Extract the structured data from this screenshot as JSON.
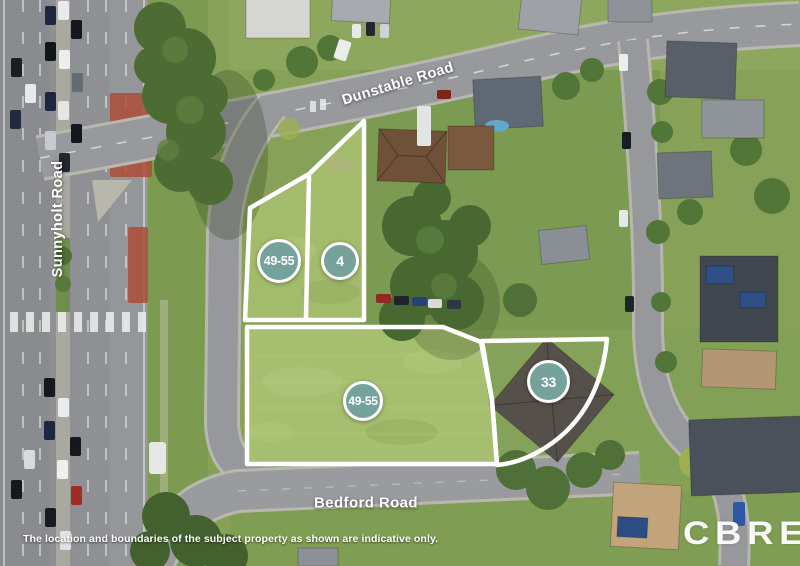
{
  "map": {
    "road_labels": [
      {
        "id": "dunstable-road",
        "name": "Dunstable Road"
      },
      {
        "id": "sunnyholt-road",
        "name": "Sunnyholt Road"
      },
      {
        "id": "bedford-road",
        "name": "Bedford Road"
      }
    ],
    "parcel_badges": [
      {
        "id": "parcel-49-55-upper",
        "label": "49-55"
      },
      {
        "id": "parcel-4",
        "label": "4"
      },
      {
        "id": "parcel-49-55-lower",
        "label": "49-55"
      },
      {
        "id": "parcel-33",
        "label": "33"
      }
    ]
  },
  "branding": {
    "logo_text": "CBRE"
  },
  "footer": {
    "disclaimer": "The location and boundaries of the subject property as shown are indicative only."
  },
  "colors": {
    "badge_fill": "#75a29a",
    "badge_text": "#ffffff",
    "boundary_stroke": "#ffffff",
    "label_text": "#ffffff",
    "logo_text_color": "#ffffff"
  }
}
